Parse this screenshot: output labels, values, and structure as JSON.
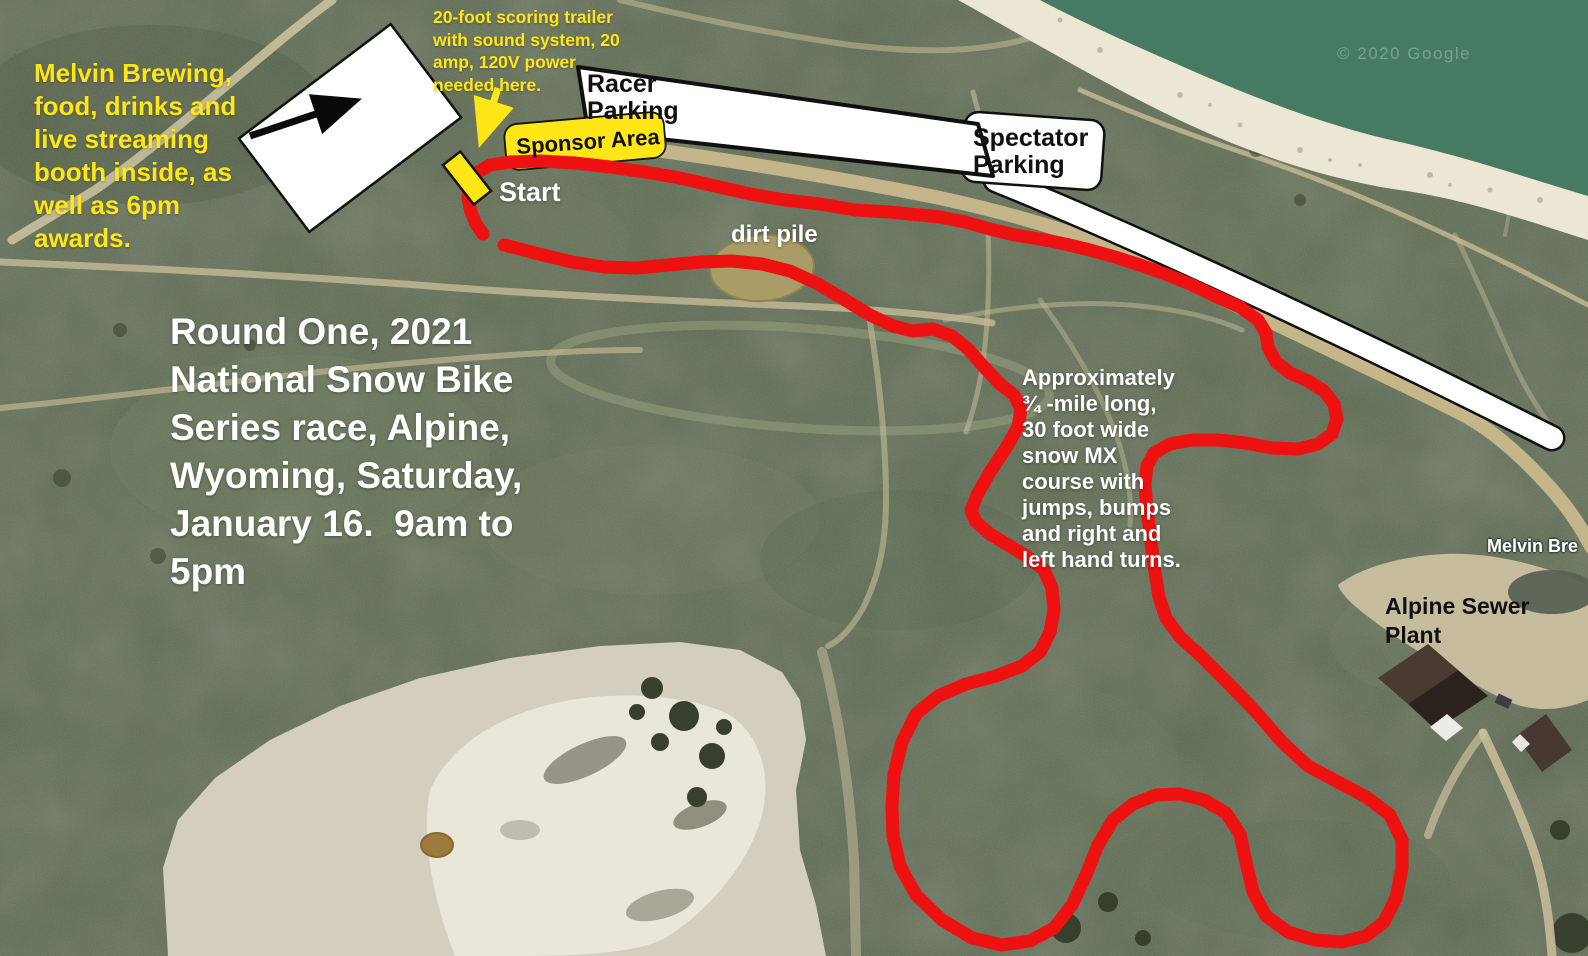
{
  "annotations": {
    "melvin_booth": {
      "lines": [
        "Melvin Brewing,",
        "food, drinks and",
        "live streaming",
        "booth inside, as",
        "well as 6pm",
        "awards."
      ]
    },
    "scoring_trailer": {
      "lines": [
        "20-foot scoring trailer",
        "with sound system, 20",
        "amp, 120V power",
        "needed here."
      ]
    },
    "racer_parking": {
      "lines": [
        "Racer",
        "Parking"
      ]
    },
    "spectator_parking": {
      "lines": [
        "Spectator",
        "Parking"
      ]
    },
    "sponsor_area": {
      "label": "Sponsor Area"
    },
    "start": {
      "label": "Start"
    },
    "dirt_pile": {
      "label": "dirt pile"
    },
    "event_title": {
      "lines": [
        "Round One, 2021",
        "National Snow Bike",
        "Series race, Alpine,",
        "Wyoming, Saturday,",
        "January 16.  9am to",
        "5pm"
      ]
    },
    "course_description": {
      "lines": [
        "Approximately",
        "¾ -mile long,",
        "30 foot wide",
        "snow MX",
        "course with",
        "jumps, bumps",
        "and right and",
        "left hand turns."
      ]
    },
    "alpine_sewer_plant": {
      "lines": [
        "Alpine Sewer",
        "Plant"
      ]
    },
    "melvin_brewing_poi": {
      "label": "Melvin Bre"
    },
    "watermark": "© 2020 Google"
  },
  "colors": {
    "course_red": "#ee1111",
    "annotation_yellow": "#ffe616",
    "terrain_green": "#59674c",
    "water_green": "#467a63",
    "beach_sand": "#ece7d5",
    "trail_tan": "#c5b58b",
    "parking_white": "#ffffff",
    "dirt_pile_tan": "#a99c67"
  }
}
